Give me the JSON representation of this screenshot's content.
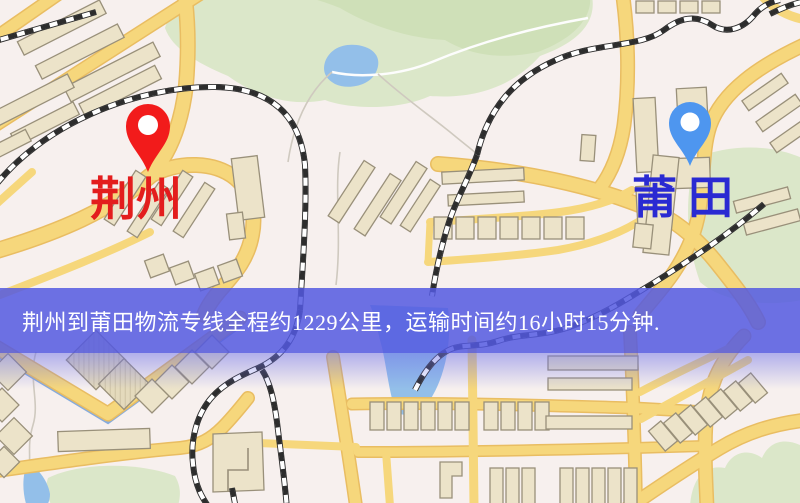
{
  "banner": {
    "text": "荆州到莆田物流专线全程约1229公里，运输时间约16小时15分钟.",
    "bg_color": "#5459e0d9",
    "text_color": "#ffffff"
  },
  "pins": {
    "origin": {
      "label": "荆州",
      "pin_color": "#f21b1b",
      "label_color": "#e31d1d"
    },
    "destination": {
      "label": "莆田",
      "pin_color": "#4e96ef",
      "label_color": "#2a2ad2"
    }
  },
  "palette": {
    "map-bg": "#f7f0ee",
    "road": "#f6d77c",
    "road-casing": "#e9bd62",
    "building": "#ece3c9",
    "building-stroke": "#99907a",
    "park": "#dbe7c9",
    "park-dark": "#cfe0b8",
    "water": "#93bfe9",
    "rail": "#2d2d2d",
    "rail-light": "#ffffff"
  }
}
